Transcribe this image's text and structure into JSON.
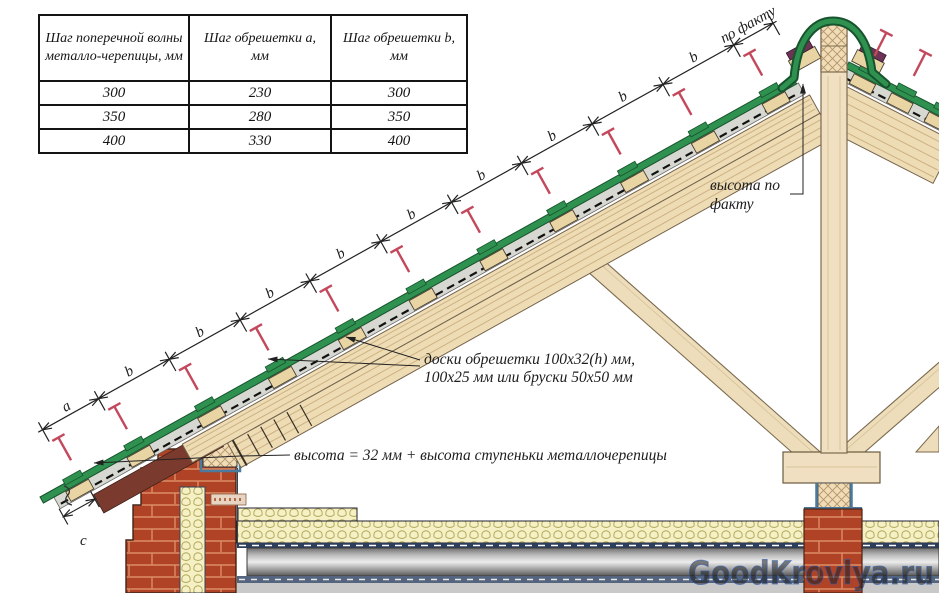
{
  "table": {
    "headers": [
      "Шаг поперечной волны металло-черепицы, мм",
      "Шаг обрешетки а, мм",
      "Шаг обрешетки b, мм"
    ],
    "rows": [
      [
        "300",
        "230",
        "300"
      ],
      [
        "350",
        "280",
        "350"
      ],
      [
        "400",
        "330",
        "400"
      ]
    ]
  },
  "annotations": {
    "po_faktu": "по факту",
    "vysota_po_faktu": [
      "высота по",
      "факту"
    ],
    "doski": [
      "доски обрешетки 100х32(h) мм,",
      "100х25 мм или бруски 50х50 мм"
    ],
    "vysota_formula": "высота = 32 мм + высота ступеньки металлочерепицы",
    "dim_a": "a",
    "dim_b": "b",
    "dim_c": "c"
  },
  "watermark": "GoodKrovlya.ru",
  "colors": {
    "tile_green": "#2f9150",
    "tile_green_dark": "#17532c",
    "seal_purple": "#6e3355",
    "wood_light": "#f0e0c1",
    "wood_batten": "#e9d5a4",
    "brick_red": "#b04226",
    "screw_red": "#c4485c",
    "insulation_yellow": "#f5f1c4",
    "membrane_blue": "#2c3e5e",
    "watermark_blue": "#4677d0"
  }
}
